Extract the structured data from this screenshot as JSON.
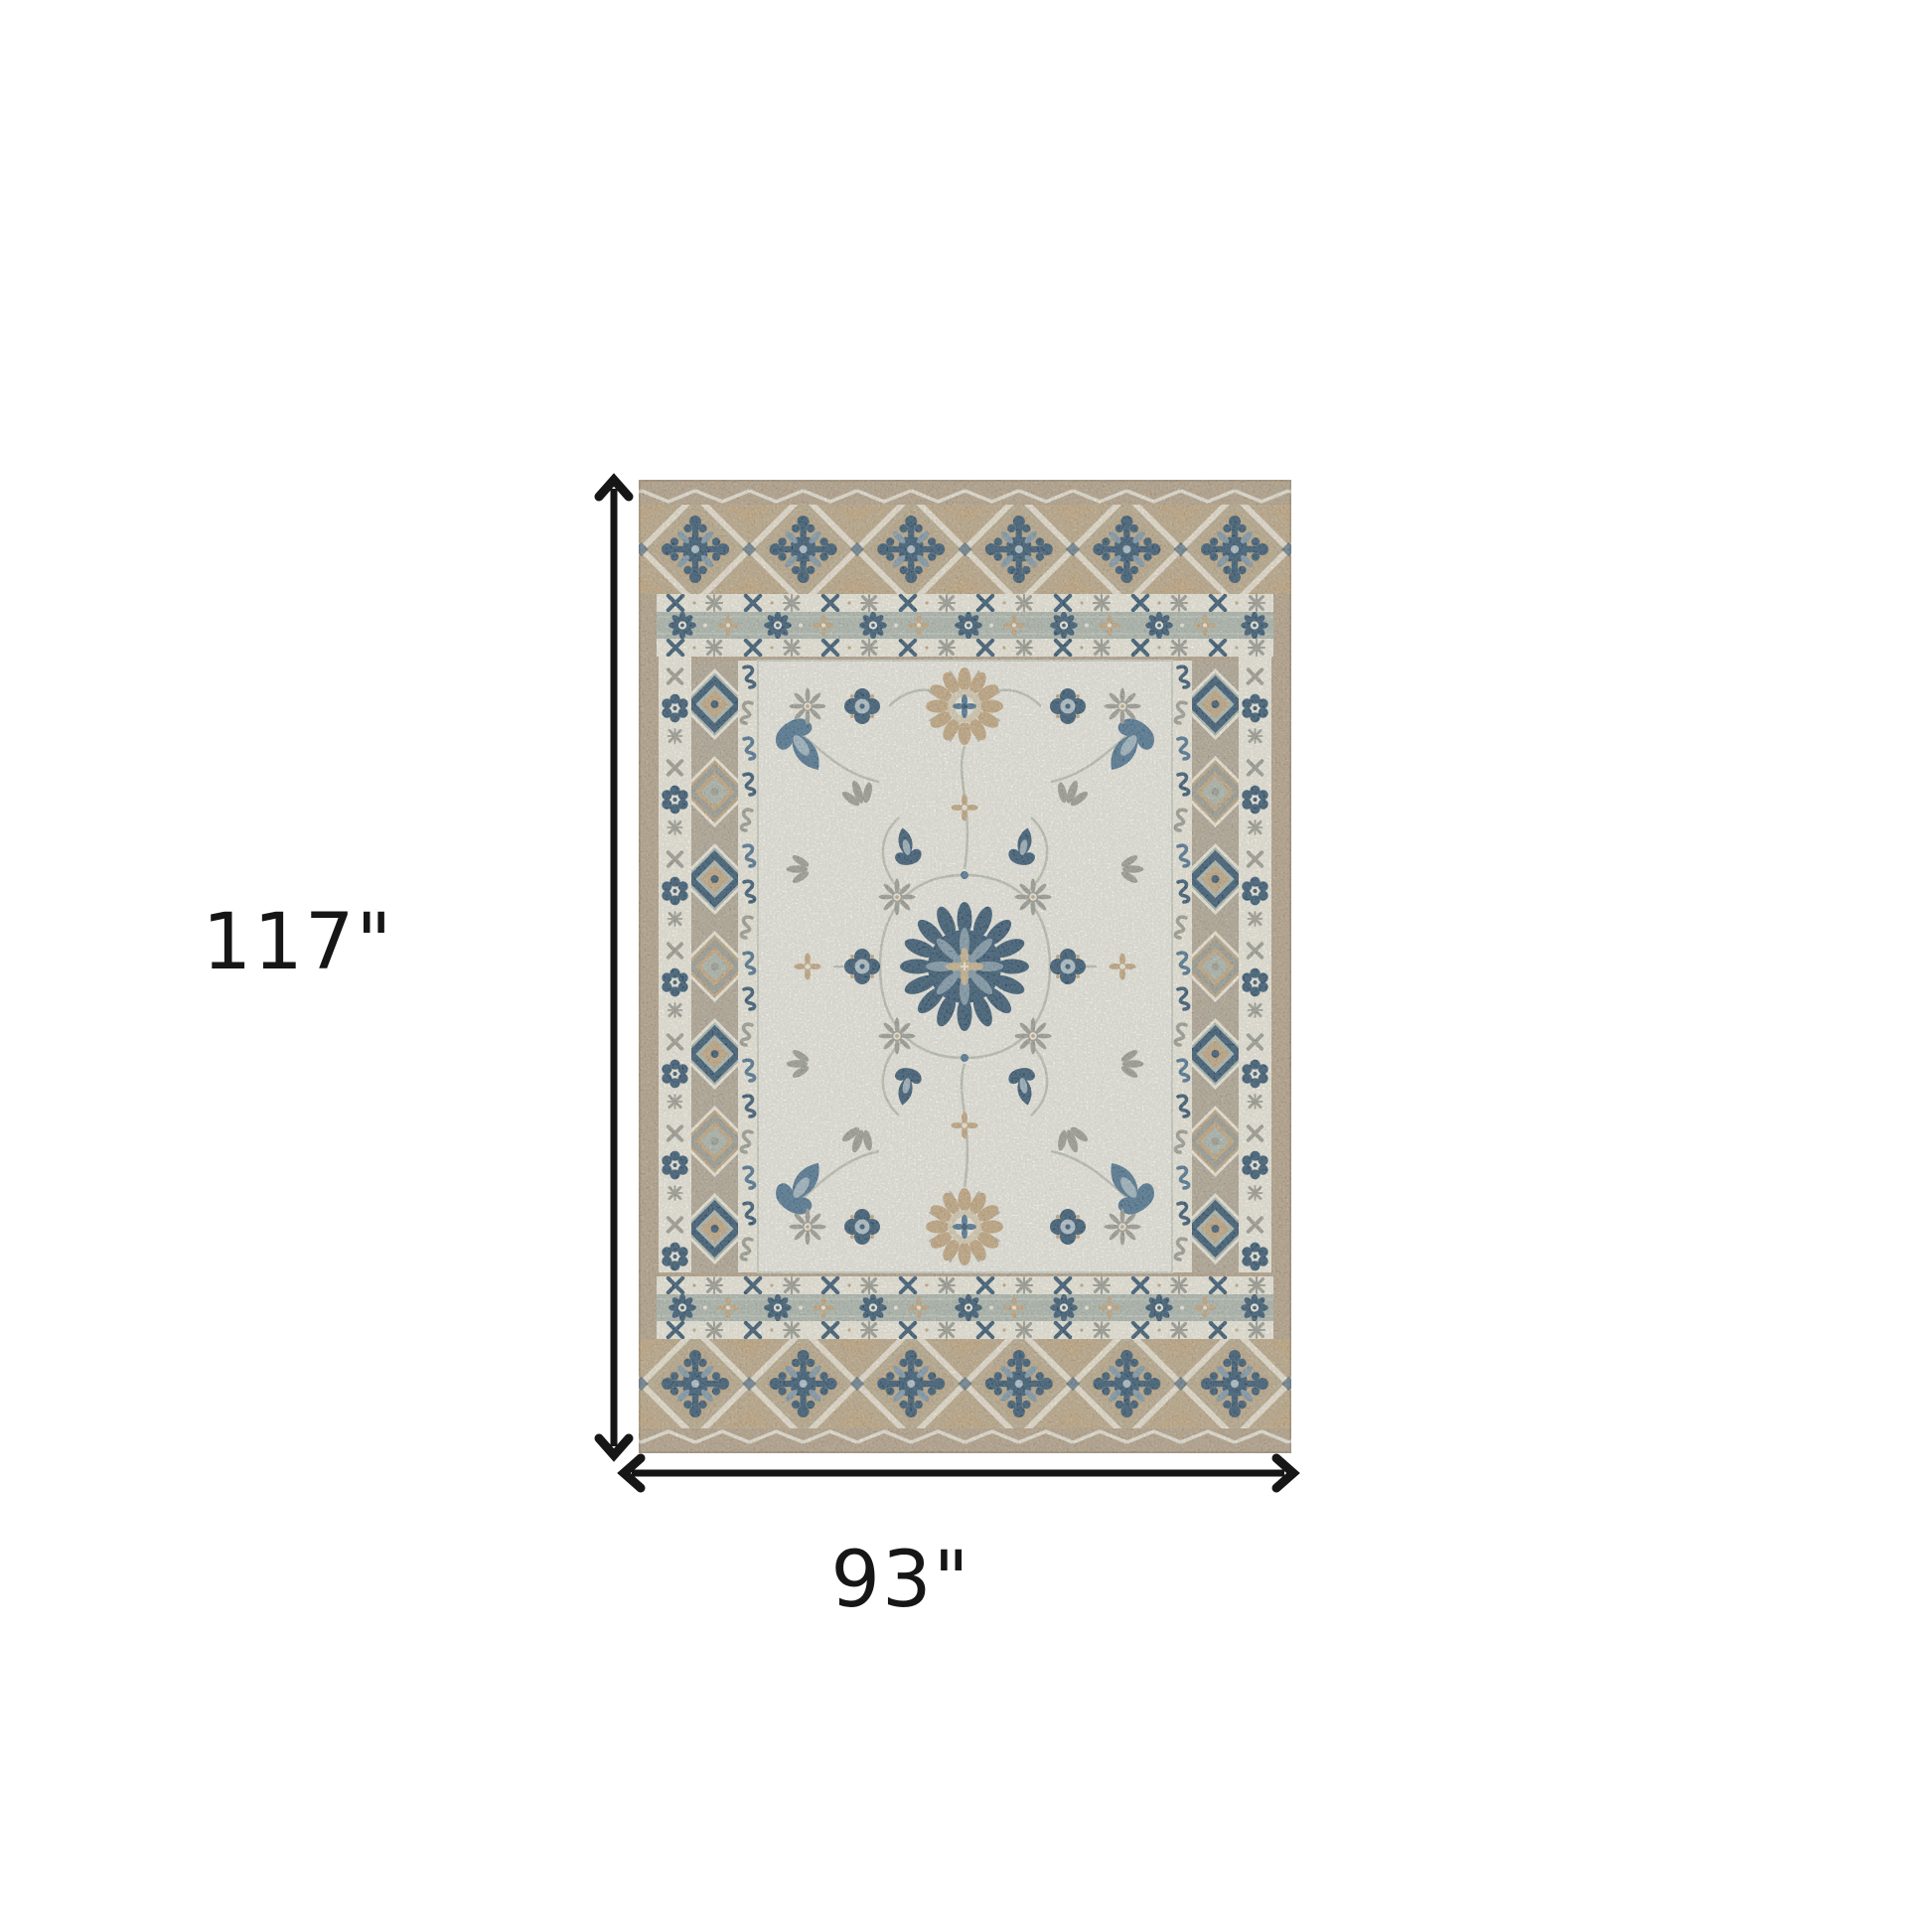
{
  "page": {
    "background": "#ffffff"
  },
  "dimension_annotation": {
    "height_label": "117\"",
    "width_label": "93\"",
    "height_value": 117,
    "width_value": 93,
    "unit": "inches",
    "arrow_color": "#161616",
    "label_color": "#161616"
  },
  "rug": {
    "description": "ivory blue and taupe oriental floral area rug",
    "palette": {
      "field": "#edece3",
      "ivory": "#efecdf",
      "taupe_edge": "#b4a289",
      "taupe_band": "#bca887",
      "taupe_col": "#b2a794",
      "tan": "#c2a67e",
      "sage": "#acb7ae",
      "sage_light": "#c9d0c4",
      "blue_dark": "#30536e",
      "blue_mid": "#49718f",
      "blue_steel": "#7d97a8",
      "blue_light": "#adc0ca",
      "gray": "#9b9c92",
      "lattice": "#eae3d2",
      "vine": "#b7bdae",
      "beige": "#c9b48e"
    }
  }
}
